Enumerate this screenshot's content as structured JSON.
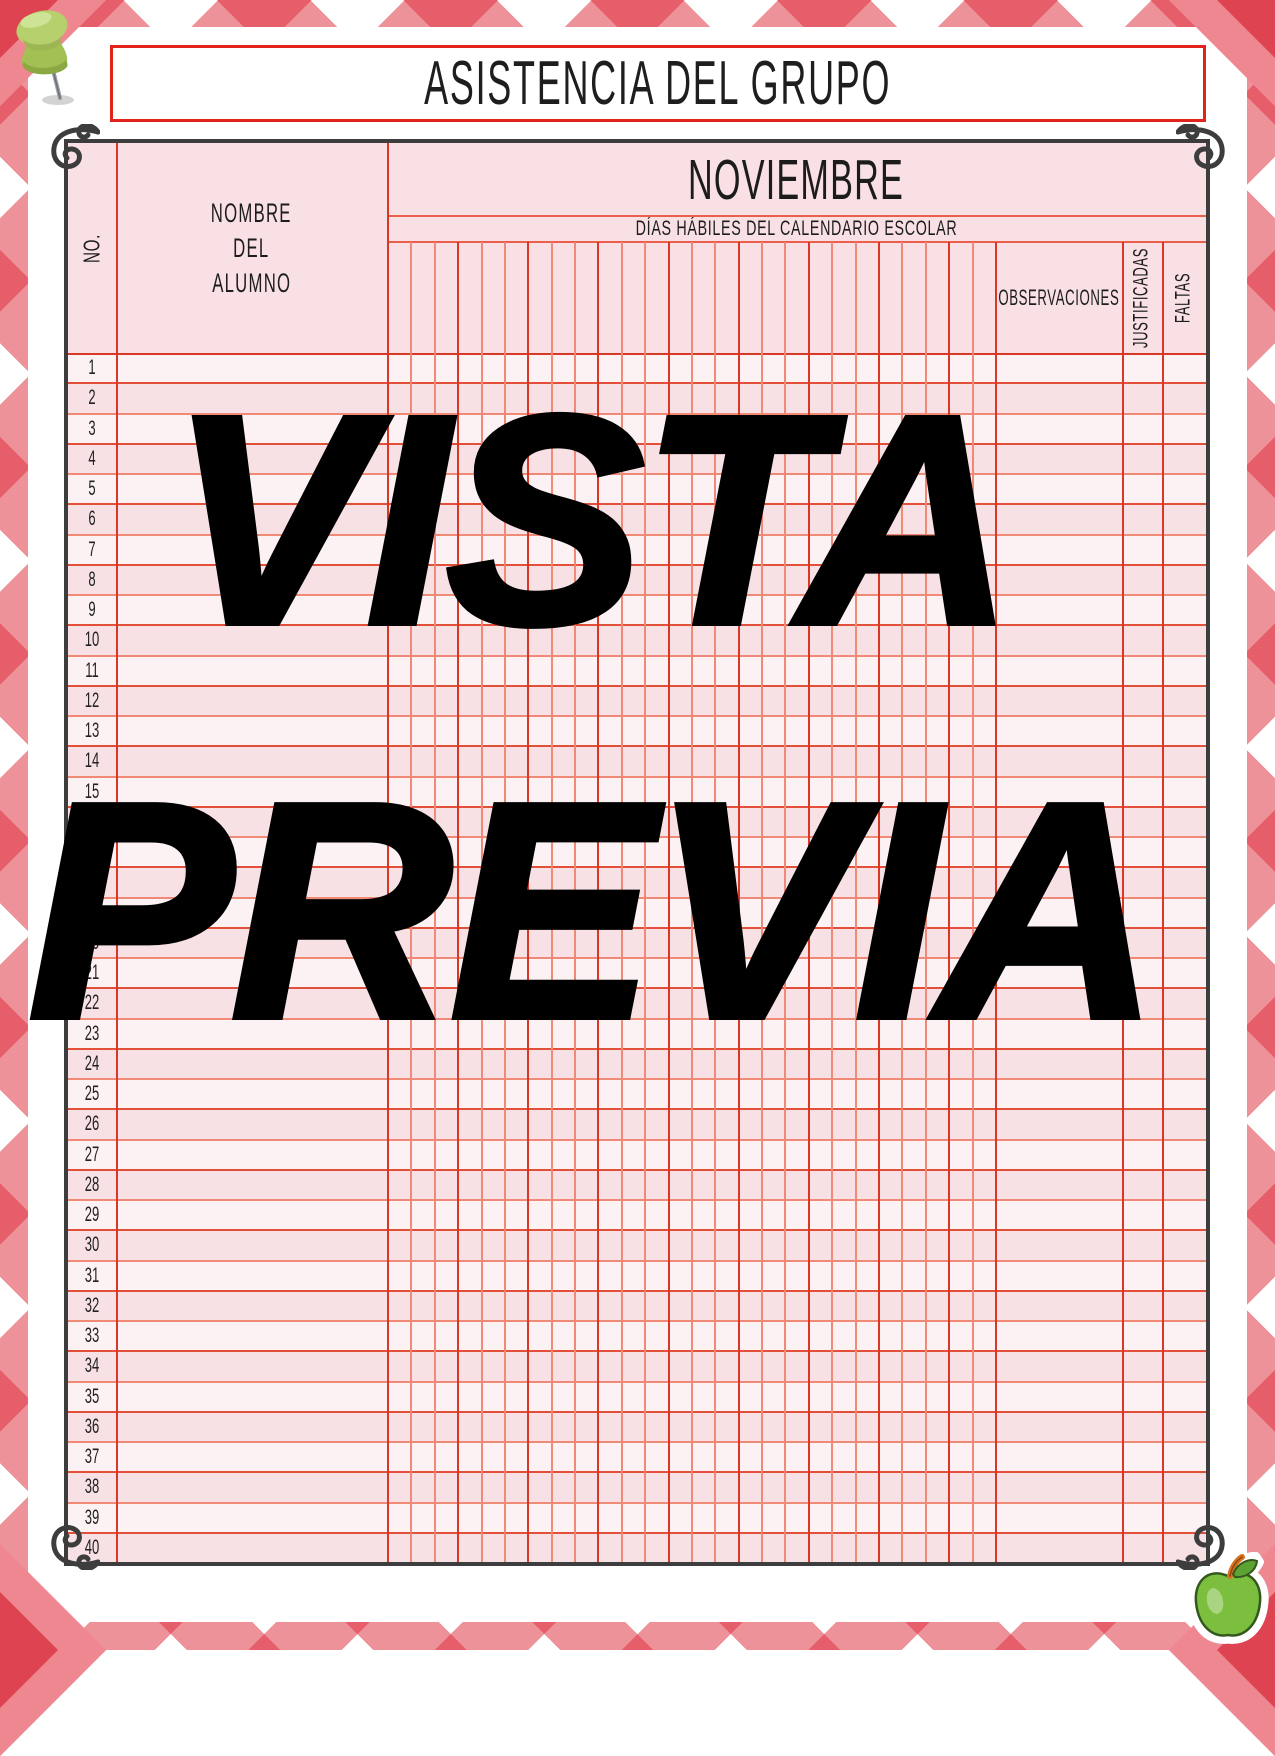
{
  "title": "ASISTENCIA DEL GRUPO",
  "watermark": {
    "line1": "VISTA",
    "line2": "PREVIA"
  },
  "table": {
    "no_header": "NO.",
    "name_header_lines": [
      "NOMBRE",
      "DEL",
      "ALUMNO"
    ],
    "month": "NOVIEMBRE",
    "days_subtitle": "DÍAS HÁBILES DEL CALENDARIO ESCOLAR",
    "observations_header": "OBSERVACIONES",
    "justified_header": "JUSTIFICADAS",
    "absences_header": "FALTAS",
    "day_column_count": 26,
    "row_numbers": [
      1,
      2,
      3,
      4,
      5,
      6,
      7,
      8,
      9,
      10,
      11,
      12,
      13,
      14,
      15,
      16,
      17,
      18,
      19,
      20,
      21,
      22,
      23,
      24,
      25,
      26,
      27,
      28,
      29,
      30,
      31,
      32,
      33,
      34,
      35,
      36,
      37,
      38,
      39,
      40
    ]
  },
  "icons": {
    "top_left": "pushpin-icon",
    "bottom_right": "apple-icon",
    "corners": "flourish-icon"
  },
  "colors": {
    "plaid_red": "#e02f3e",
    "plaid_dark": "#dd4350",
    "title_border": "#e0231c",
    "frame": "#3d3d3d",
    "sheet_pink": "#f8e0e4",
    "row_light": "#fcf1f3",
    "row_pink": "#f8e1e5",
    "grid_bright": "#da3827",
    "grid_salmon": "#f08a76",
    "watermark": "#000000"
  }
}
